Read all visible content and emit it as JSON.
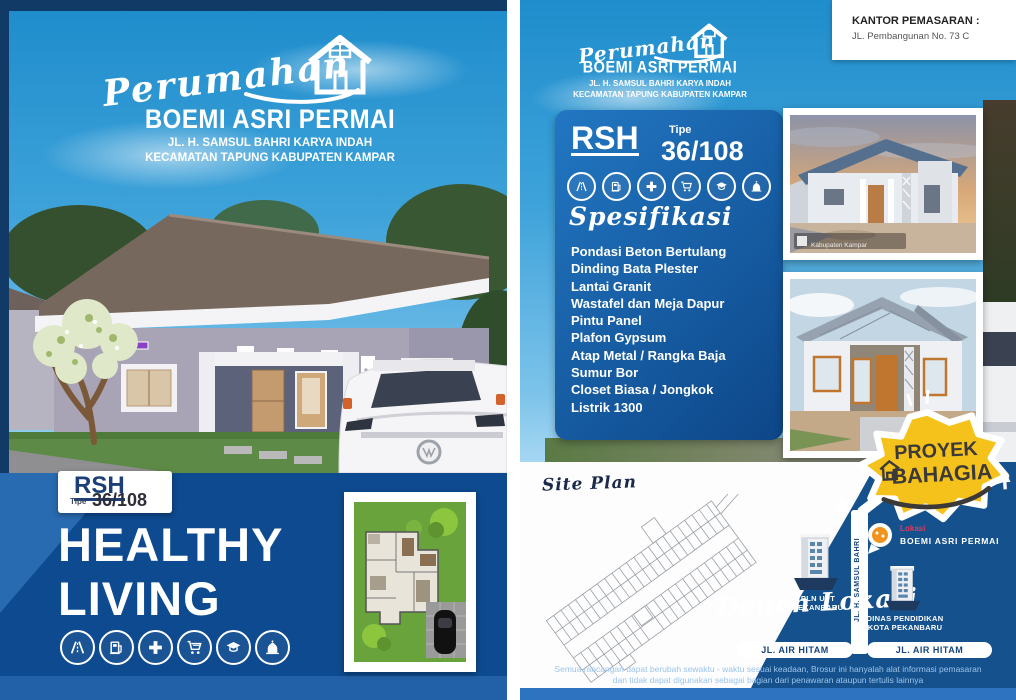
{
  "colors": {
    "sky_blue": "#2f9ad7",
    "navy_band": "#0d4a8f",
    "map_navy": "#15518c",
    "spec_box_blue": "#1e6fb5",
    "badge_yellow": "#f5c21c",
    "lokasi_red": "#e03a5e",
    "bottom_strip_blue": "#2e73c0"
  },
  "left_page": {
    "logo": {
      "script": "Perumahan",
      "name": "BOEMI ASRI PERMAI",
      "address_line1": "JL. H. SAMSUL BAHRI KARYA INDAH",
      "address_line2": "KECAMATAN TAPUNG KABUPATEN KAMPAR"
    },
    "type_badge": {
      "code": "RSH",
      "tipe_label": "Tipe",
      "tipe_value": "36/108"
    },
    "headline_line1": "HEALTHY",
    "headline_line2": "LIVING",
    "amenity_icons": [
      "highway-icon",
      "fuel-icon",
      "medical-icon",
      "cart-icon",
      "education-icon",
      "mosque-icon"
    ]
  },
  "right_page": {
    "marketing_office": {
      "title": "KANTOR PEMASARAN :",
      "address": "JL. Pembangunan No. 73 C"
    },
    "logo": {
      "script": "Perumahan",
      "name": "BOEMI ASRI PERMAI",
      "address_line1": "JL. H. SAMSUL BAHRI KARYA INDAH",
      "address_line2": "KECAMATAN TAPUNG KABUPATEN KAMPAR"
    },
    "type_badge": {
      "code": "RSH",
      "tipe_label": "Tipe",
      "tipe_value": "36/108"
    },
    "amenity_icons": [
      "highway-icon",
      "fuel-icon",
      "medical-icon",
      "cart-icon",
      "education-icon",
      "mosque-icon"
    ],
    "spec": {
      "title": "Spesifikasi",
      "items": [
        "Pondasi Beton Bertulang",
        "Dinding Bata Plester",
        "Lantai Granit",
        "Wastafel dan Meja Dapur",
        "Pintu Panel",
        "Plafon Gypsum",
        "Atap Metal / Rangka Baja",
        "Sumur Bor",
        "Closet Biasa / Jongkok",
        "Listrik 1300"
      ]
    },
    "photo1": {
      "watermark": "Kabupaten Kampar"
    },
    "proyek_badge": {
      "line1": "PROYEK",
      "line2": "BAHAGIA"
    },
    "site_plan_label": "Site Plan",
    "map": {
      "title": "Denah Lokasi",
      "marker": {
        "tag": "Lokasi",
        "name": "BOEMI ASRI PERMAI"
      },
      "building1": {
        "line1": "PLN UPT",
        "line2": "PEKANBARU"
      },
      "building2": {
        "line1": "DINAS PENDIDIKAN",
        "line2": "KOTA PEKANBARU"
      },
      "road_vertical": "JL. H. SAMSUL BAHRI",
      "road_left": "JL. AIR HITAM",
      "road_right": "JL. AIR HITAM"
    },
    "disclaimer_line1": "Semua rancangan dapat berubah sewaktu - waktu sesuai keadaan, Brosur ini hanyalah alat informasi pemasaran",
    "disclaimer_line2": "dan tidak dapat digunakan sebagai bagian dari penawaran ataupun tertulis lainnya"
  }
}
